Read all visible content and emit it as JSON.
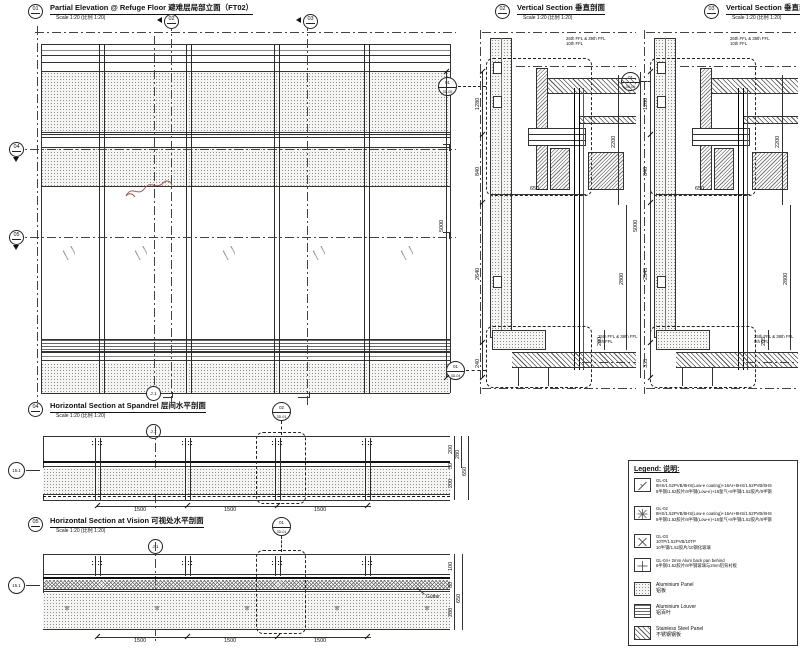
{
  "titles": {
    "d01": {
      "num": "01",
      "name": "Partial Elevation @ Refuge Floor 避难层局部立面（FT02）",
      "scale": "Scale 1:20 (比例 1:20)"
    },
    "d02": {
      "num": "02",
      "name": "Vertical Section 垂直剖面",
      "scale": "Scale 1:20 (比例 1:20)"
    },
    "d03": {
      "num": "03",
      "name": "Vertical Section 垂直剖面",
      "scale": "Scale 1:20 (比例 1:20)"
    },
    "d04": {
      "num": "04",
      "name": "Horizontal Section at Spandrel 层间水平剖面",
      "scale": "Scale 1:20 (比例 1:20)"
    },
    "d05": {
      "num": "05",
      "name": "Horizontal Section at Vision 可视处水平剖面",
      "scale": "Scale 1:20 (比例 1:20)"
    }
  },
  "elevation": {
    "cuts": {
      "m02": "02",
      "m03": "03",
      "m04": "04",
      "m05": "05"
    },
    "grid_j1": "J.1",
    "callout_top": {
      "num": "01",
      "ref": "3D-05"
    },
    "callout_bottom": {
      "num": "01",
      "ref": "3D-04"
    }
  },
  "section02": {
    "dims": {
      "total": "5000",
      "seg1": "1280",
      "seg2": "840",
      "seg3": "2640",
      "seg4": "240",
      "width": "650",
      "right_top": "2200",
      "right_bottom": "2800",
      "right_small": "200"
    },
    "ffl_top1": "26th FFL & 39th FFL",
    "ffl_top2": "10th FFL",
    "ffl_bot1": "25th FFL & 38th FFL",
    "ffl_bot2": "9th FFL"
  },
  "section03": {
    "dims": {
      "total": "5000",
      "seg1": "1280",
      "seg2": "840",
      "seg3": "2545",
      "seg4": "335",
      "width": "650",
      "right_top": "2200",
      "right_bottom": "2800",
      "right_small": "205"
    },
    "ffl_top1": "26th FFL & 39th FFL",
    "ffl_top2": "10th FFL",
    "ffl_bot1": "25th FFL & 38th FFL",
    "ffl_bot2": "9th FFL",
    "callout_top": {
      "num": "01",
      "ref": "3D-05"
    }
  },
  "section04": {
    "grid_row": "15.1",
    "grid_j1": "J.1",
    "callout": {
      "num": "02",
      "ref": "3D-01"
    },
    "bottom_dims": [
      "1500",
      "1500",
      "1500"
    ],
    "right_dims": {
      "a": "200",
      "b": "50",
      "c": "200",
      "d": "280",
      "e": "650"
    }
  },
  "section05": {
    "grid_row": "15.1",
    "grid_j1": "J.1",
    "callout": {
      "num": "01",
      "ref": "3D-01"
    },
    "bottom_dims": [
      "1500",
      "1500",
      "1500"
    ],
    "right_dims": {
      "a": "100",
      "b": "80",
      "c": "200",
      "d": "650"
    },
    "gutter": "Gutter"
  },
  "legend": {
    "title": "Legend:  说明:",
    "items": [
      {
        "t1": "GL-01",
        "t2": "8HS/1.52PVB/8HS(Low-e coating)+16Ar+8HS/1.52PVB/8HS",
        "t3": "8半钢/1.52胶片/8半钢(Low-e)+16氩气+8半钢/1.52胶片/8半钢"
      },
      {
        "t1": "GL-02",
        "t2": "8HS/1.52PVB/8HS(Low-e coating)+16Ar+8HS/1.52PVB/8HS",
        "t3": "8半钢/1.52胶片/8半钢(Low-e)+16氩气+8半钢/1.52胶片/8半钢"
      },
      {
        "t1": "GL-03",
        "t2": "10TP/1.52PVB/10TP",
        "t3": "10半钢/1.52胶片/10钢化玻璃"
      },
      {
        "t1": "GL-04+ 2mm Alum back pan behind",
        "t2": "8半钢/1.52胶片/8半钢玻璃与2mm铝背衬板",
        "t3": ""
      },
      {
        "t1": "Aluminium Panel",
        "t2": "铝板",
        "t3": ""
      },
      {
        "t1": "Aluminium Louver",
        "t2": "铝百叶",
        "t3": ""
      },
      {
        "t1": "Stainless Steel Panel",
        "t2": "不锈钢钢板",
        "t3": ""
      }
    ]
  }
}
